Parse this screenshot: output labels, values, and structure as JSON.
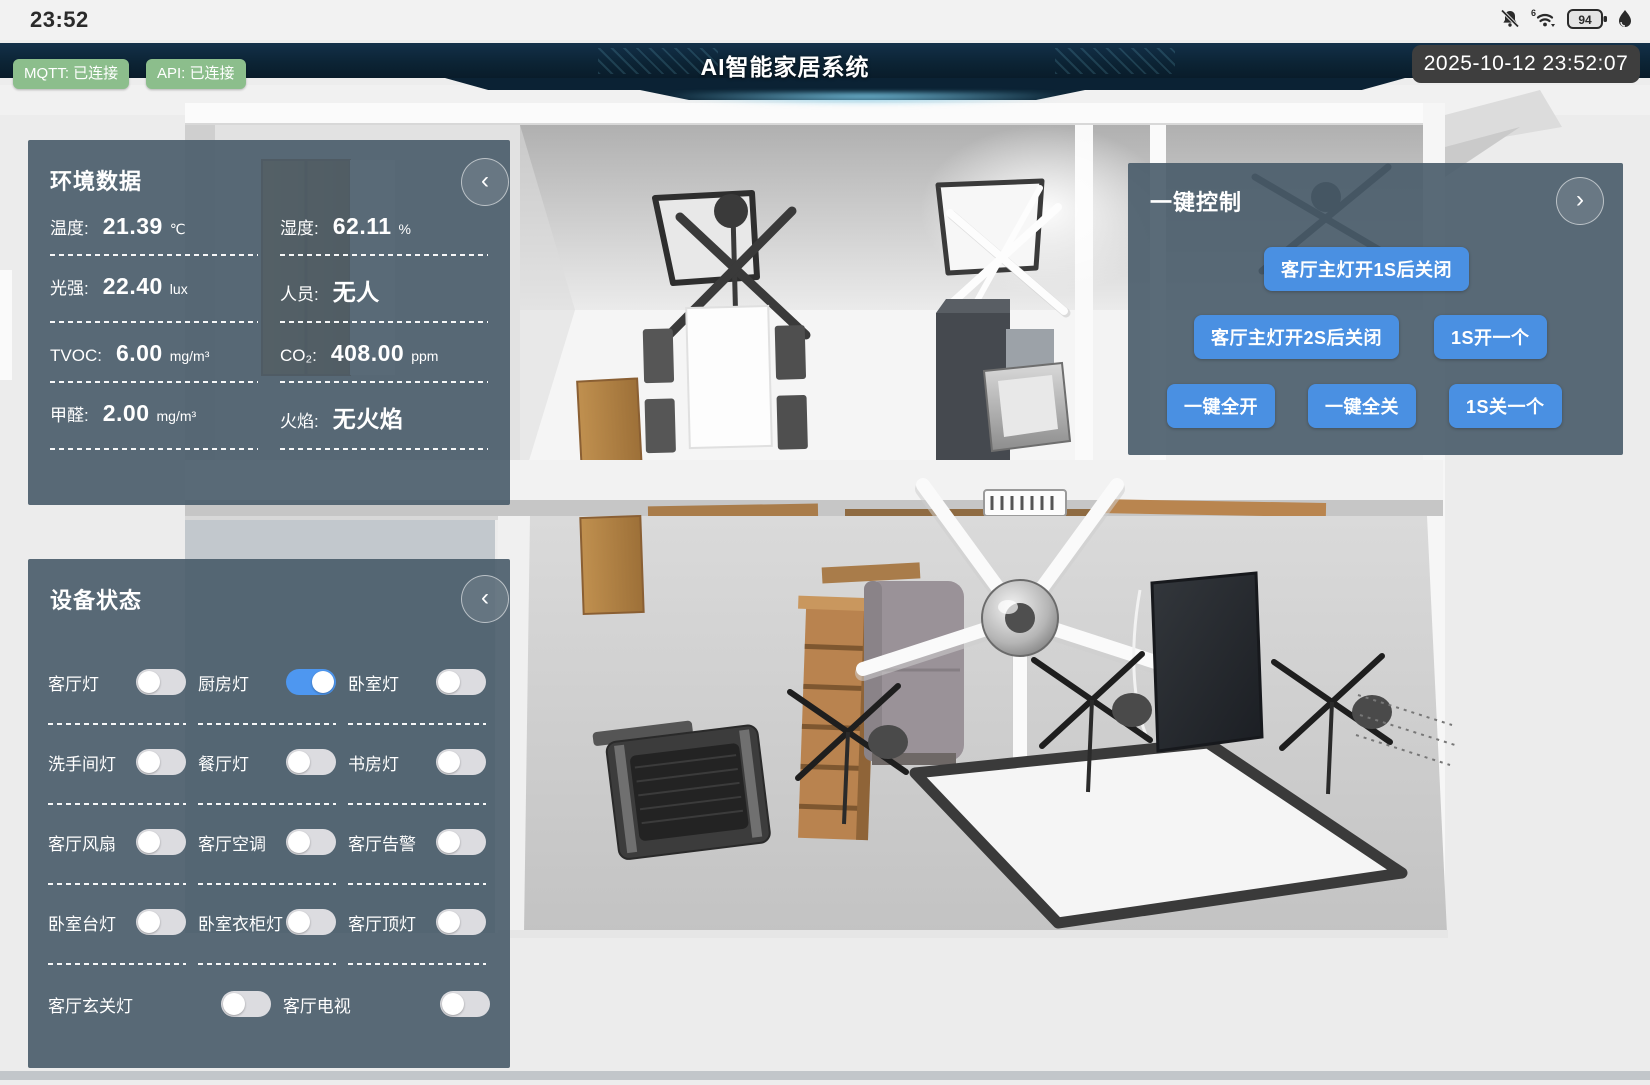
{
  "status_bar": {
    "time": "23:52",
    "battery_level": "94",
    "wifi_label": "6"
  },
  "header": {
    "title": "AI智能家居系统",
    "mqtt_status": "MQTT: 已连接",
    "api_status": "API: 已连接",
    "datetime": "2025-10-12 23:52:07"
  },
  "env_panel": {
    "title": "环境数据",
    "collapse_glyph": "‹",
    "rows": [
      [
        {
          "label": "温度:",
          "value": "21.39",
          "unit": "℃"
        },
        {
          "label": "湿度:",
          "value": "62.11",
          "unit": "%"
        }
      ],
      [
        {
          "label": "光强:",
          "value": "22.40",
          "unit": "lux"
        },
        {
          "label": "人员:",
          "value": "无人",
          "unit": ""
        }
      ],
      [
        {
          "label": "TVOC:",
          "value": "6.00",
          "unit": "mg/m³"
        },
        {
          "label": "CO₂:",
          "value": "408.00",
          "unit": "ppm"
        }
      ],
      [
        {
          "label": "甲醛:",
          "value": "2.00",
          "unit": "mg/m³"
        },
        {
          "label": "火焰:",
          "value": "无火焰",
          "unit": ""
        }
      ]
    ]
  },
  "control_panel": {
    "title": "一键控制",
    "expand_glyph": "›",
    "rows": [
      [
        "客厅主灯开1S后关闭"
      ],
      [
        "客厅主灯开2S后关闭",
        "1S开一个"
      ],
      [
        "一键全开",
        "一键全关",
        "1S关一个"
      ]
    ]
  },
  "device_panel": {
    "title": "设备状态",
    "collapse_glyph": "‹",
    "rows": [
      [
        {
          "label": "客厅灯",
          "on": false
        },
        {
          "label": "厨房灯",
          "on": true
        },
        {
          "label": "卧室灯",
          "on": false
        }
      ],
      [
        {
          "label": "洗手间灯",
          "on": false
        },
        {
          "label": "餐厅灯",
          "on": false
        },
        {
          "label": "书房灯",
          "on": false
        }
      ],
      [
        {
          "label": "客厅风扇",
          "on": false
        },
        {
          "label": "客厅空调",
          "on": false
        },
        {
          "label": "客厅告警",
          "on": false
        }
      ],
      [
        {
          "label": "卧室台灯",
          "on": false
        },
        {
          "label": "卧室衣柜灯",
          "on": false
        },
        {
          "label": "客厅顶灯",
          "on": false
        }
      ],
      [
        {
          "label": "客厅玄关灯",
          "on": false
        },
        {
          "label": "客厅电视",
          "on": false
        }
      ]
    ]
  },
  "colors": {
    "accent_blue": "#4a90e2",
    "toggle_on": "#4e97f0",
    "toggle_off": "#dcdce0",
    "badge_green": "#8cbe8c",
    "header_navy": "#0c2435",
    "panel_slate": "rgba(72,91,105,0.9)",
    "timestamp_bg": "#3e3e3e"
  }
}
